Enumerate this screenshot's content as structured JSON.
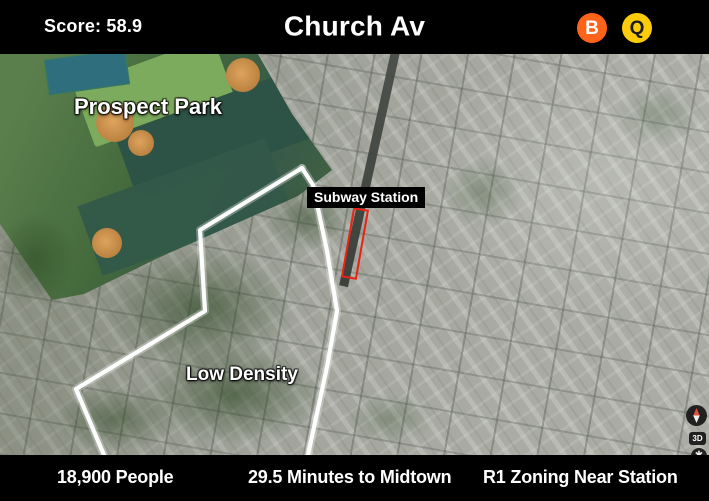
{
  "header": {
    "score": "Score: 58.9",
    "title": "Church Av",
    "subway_lines": [
      {
        "label": "B",
        "color": "#ff6319",
        "text_color": "#ffffff"
      },
      {
        "label": "Q",
        "color": "#fccc0a",
        "text_color": "#1a1a1a"
      }
    ]
  },
  "map": {
    "type": "satellite-aerial",
    "annotations": {
      "park_label": "Prospect Park",
      "station_label": "Subway Station",
      "density_label": "Low Density"
    },
    "station_highlight_color": "#ea2113",
    "walkshed_outline_color": "#ffffff",
    "controls": {
      "mode_toggle_label": "3D",
      "gear_glyph": "✱"
    }
  },
  "footer": {
    "stats": [
      "18,900 People",
      "29.5 Minutes to Midtown",
      "R1 Zoning Near Station"
    ]
  }
}
